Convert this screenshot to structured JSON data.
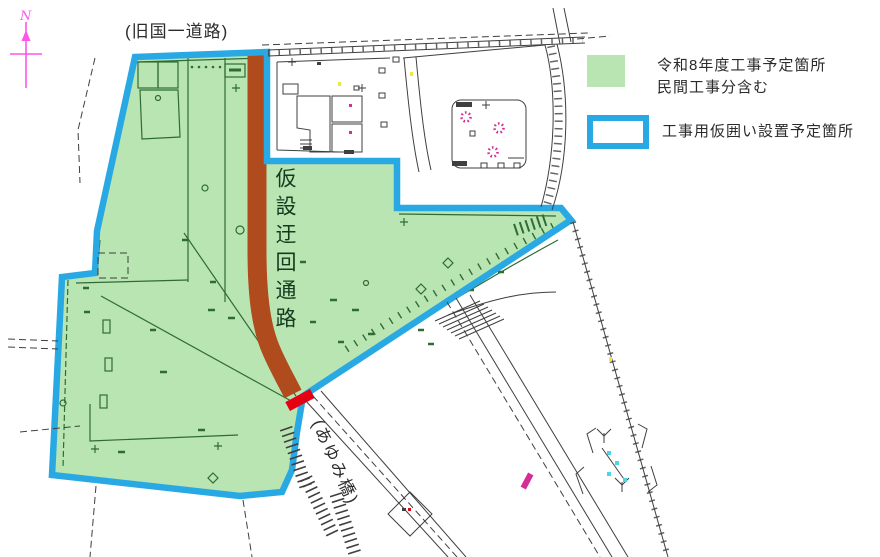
{
  "labels": {
    "north_letter": "N",
    "old_route_road": "(旧国一道路)",
    "detour_route": "仮設迂回通路",
    "ayumi_bridge": "(あゆみ橋)"
  },
  "legend": {
    "items": [
      {
        "swatch": "green-fill",
        "line1": "令和8年度工事予定箇所",
        "line2": "民間工事分含む"
      },
      {
        "swatch": "blue-outline",
        "label": "工事用仮囲い設置予定箇所"
      }
    ]
  },
  "colors": {
    "site_fill": "#b9e5b2",
    "site_line": "#2f6b35",
    "fence_blue": "#29a9e3",
    "detour_brown": "#b04b1d",
    "stop_red": "#e60014",
    "accent_magenta": "#d62c96",
    "north_pink": "#ff55e8",
    "map_cyan": "#45d8e8",
    "map_yellow": "#f2e44a",
    "ink": "#3f3f3f",
    "label_text": "#2b2b2b"
  }
}
